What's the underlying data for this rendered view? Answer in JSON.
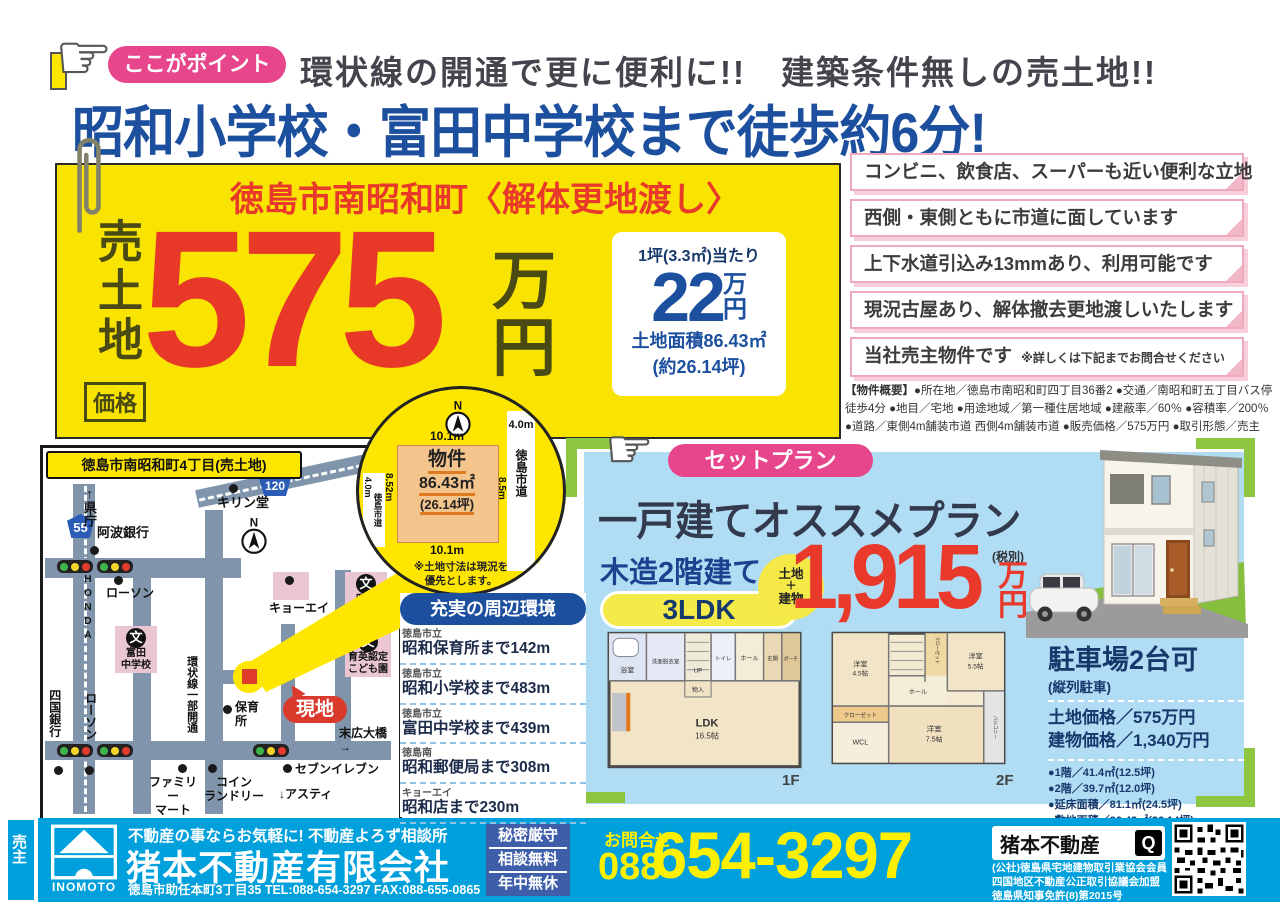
{
  "colors": {
    "accent_red": "#e73828",
    "accent_yellow": "#f9e300",
    "brand_blue": "#1d4f9f",
    "footer_blue": "#00a0dc",
    "badge_pink": "#e8468c",
    "plan_bg_blue": "#b0dcf4",
    "bracket_green": "#8dc63f"
  },
  "header": {
    "badge": "ここがポイント",
    "subtitle": "環状線の開通で更に便利に!!　建築条件無しの売土地!!",
    "title": "昭和小学校・富田中学校まで徒歩約6分!"
  },
  "price_box": {
    "location_title": "徳島市南昭和町〈解体更地渡し〉",
    "sale_label": "売土地",
    "price_label": "価格",
    "price_number": "575",
    "price_unit1": "万",
    "price_unit2": "円",
    "per_label": "1坪(3.3㎡)当たり",
    "per_number": "22",
    "per_unit1": "万",
    "per_unit2": "円",
    "area_line1": "土地面積86.43㎡",
    "area_line2": "(約26.14坪)"
  },
  "features": [
    "コンビニ、飲食店、スーパーも近い便利な立地",
    "西側・東側ともに市道に面しています",
    "上下水道引込み13mmあり、利用可能です",
    "現況古屋あり、解体撤去更地渡しいたします",
    "当社売主物件です"
  ],
  "features_note": "※詳しくは下記までお問合せください",
  "overview": {
    "label": "【物件概要】",
    "text": "●所在地／徳島市南昭和町四丁目36番2 ●交通／南昭和町五丁目バス停徒歩4分 ●地目／宅地 ●用途地域／第一種住居地域 ●建蔽率／60％ ●容積率／200％ ●道路／東側4m舗装市道 西側4m舗装市道 ●販売価格／575万円 ●取引形態／売主"
  },
  "map": {
    "title": "徳島市南昭和町4丁目(売土地)",
    "route55": "55",
    "route120": "120",
    "compass": "N",
    "labels": {
      "kencho": "↑県庁",
      "awabank": "阿波銀行",
      "kirindo": "キリン堂",
      "honda": "HONDA",
      "lawson1": "ローソン",
      "bun": "文",
      "tomida": "富田\n中学校",
      "kanjosen": "環状線一部開通",
      "kyoei": "キョーエイ",
      "showa_es": "昭和\n小学校",
      "ikuei": "育英認定\nこども園",
      "hoiku": "保育\n所",
      "genchi": "現地",
      "suehiro": "末広大橋→",
      "seven": "セブンイレブン",
      "famima": "ファミリー\nマート",
      "coin": "コイン\nランドリー",
      "asty": "↓アスティ",
      "shikoku": "四国銀行",
      "lawson2": "ローソン"
    }
  },
  "plot": {
    "north": "N",
    "bukken": "物件",
    "area": "86.43㎡",
    "tsubo": "(26.14坪)",
    "dim_top": "10.1m",
    "dim_bottom": "10.1m",
    "dim_left": "8.52m",
    "dim_right": "8.5m",
    "left_w": "4.0m",
    "right_w": "4.0m",
    "road_left": "徳島市道",
    "road_right": "徳島市道",
    "note": "※土地寸法は現況を\n優先とします。"
  },
  "surroundings": {
    "title": "充実の周辺環境",
    "items": [
      {
        "prefix": "徳島市立",
        "name": "昭和保育所まで142m"
      },
      {
        "prefix": "徳島市立",
        "name": "昭和小学校まで483m"
      },
      {
        "prefix": "徳島市立",
        "name": "富田中学校まで439m"
      },
      {
        "prefix": "徳島南",
        "name": "昭和郵便局まで308m"
      },
      {
        "prefix": "キョーエイ",
        "name": "昭和店まで230m"
      }
    ]
  },
  "setplan": {
    "badge": "セットプラン",
    "title": "一戸建てオススメプラン",
    "structure": "木造2階建て",
    "ldk": "3LDK",
    "circle_top": "土地",
    "circle_mid": "＋",
    "circle_bottom": "建物",
    "price": "1,915",
    "price_unit1": "万",
    "price_unit2": "円",
    "tax_note": "(税別)",
    "f1_label": "1F",
    "f2_label": "2F",
    "parking": {
      "title": "駐車場2台可",
      "subtitle": "(縦列駐車)",
      "land_price": "土地価格／575万円",
      "building_price": "建物価格／1,340万円",
      "details": [
        "●1階／41.4㎡(12.5坪)",
        "●2階／39.7㎡(12.0坪)",
        "●延床面積／81.1㎡(24.5坪)",
        "●敷地面積／86.43㎡(26.14坪)"
      ]
    }
  },
  "floor1": {
    "bath": "浴室",
    "wash": "洗面脱衣室",
    "up": "UP",
    "toilet": "トイレ",
    "hall": "ホール",
    "entry": "玄関",
    "porch": "ポーチ",
    "storage": "物入",
    "ldk": "LDK",
    "ldk_size": "16.5帖"
  },
  "floor2": {
    "room1": "洋室",
    "room1_size": "4.5帖",
    "closet1": "クローゼット",
    "room2": "洋室",
    "room2_size": "5.5帖",
    "hall": "ホール",
    "closet2": "クローゼット",
    "wcl": "WCL",
    "room3": "洋室",
    "room3_size": "7.5帖",
    "balcony": "バルコニー"
  },
  "footer": {
    "seller_label": "売主",
    "logo_text": "INOMOTO",
    "tagline": "不動産の事ならお気軽に!  不動産よろず相談所",
    "company": "猪本不動産有限会社",
    "address": "徳島市助任本町3丁目35 TEL:088-654-3297 FAX:088-655-0865",
    "badge_rows": [
      "秘密厳守",
      "相談無料",
      "年中無休"
    ],
    "contact_label": "お問合せ",
    "phone_area": "088",
    "phone_number": "654-3297",
    "search_text": "猪本不動産",
    "search_icon": "Q",
    "memberships": [
      "(公社)徳島県宅地建物取引業協会会員",
      "四国地区不動産公正取引協議会加盟",
      "徳島県知事免許(8)第2015号"
    ]
  }
}
